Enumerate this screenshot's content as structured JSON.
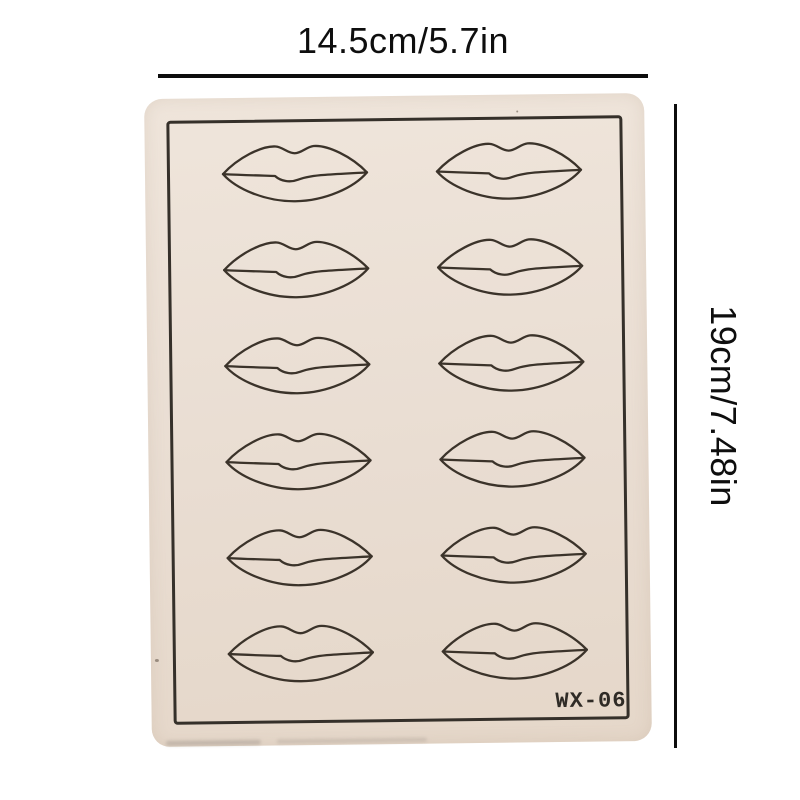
{
  "dimensions": {
    "width_label": "14.5cm/5.7in",
    "height_label": "19cm/7.48in"
  },
  "pad": {
    "model_label": "WX-06",
    "lip_count": 12,
    "grid_rows": 6,
    "grid_cols": 2
  },
  "colors": {
    "background": "#ffffff",
    "pad_fill": "#e9ddd2",
    "pad_outline": "#35302a",
    "lip_stroke": "#3b332a",
    "dimension_line": "#0d0d0d",
    "text": "#0e0e0e"
  }
}
